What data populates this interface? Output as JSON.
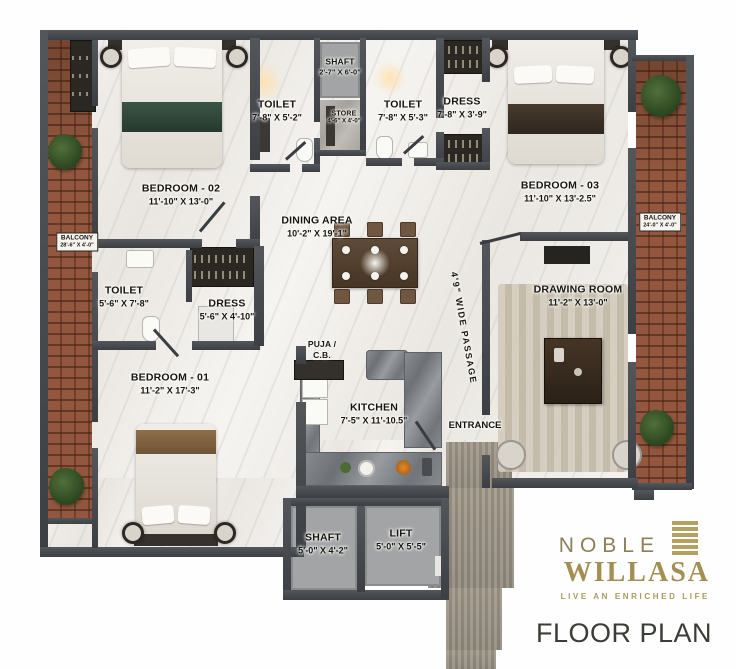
{
  "brand": {
    "name": "NOBLE",
    "logo": "WILLASA",
    "tagline": "LIVE AN ENRICHED LIFE",
    "plan_title": "FLOOR PLAN",
    "gold": "#a28f51",
    "dark": "#3a3e36"
  },
  "rooms": {
    "bedroom02": {
      "name": "BEDROOM - 02",
      "dims": "11'-10\" X 13'-0\""
    },
    "toilet_top_left": {
      "name": "TOILET",
      "dims": "7'-8\" X 5'-2\""
    },
    "shaft_top": {
      "name": "SHAFT",
      "dims": "2'-7\" X 6'-0\""
    },
    "store": {
      "name": "STORE",
      "dims": "4'-6\" X 4'-0\""
    },
    "toilet_top_right": {
      "name": "TOILET",
      "dims": "7'-8\" X 5'-3\""
    },
    "dress_top": {
      "name": "DRESS",
      "dims": "7'-8\" X 3'-9\""
    },
    "bedroom03": {
      "name": "BEDROOM - 03",
      "dims": "11'-10\" X 13'-2.5\""
    },
    "dining": {
      "name": "DINING AREA",
      "dims": "10'-2\" X 19'-1\""
    },
    "balcony_left": {
      "name": "BALCONY",
      "dims": "28'-6\" X 4'-0\""
    },
    "balcony_right": {
      "name": "BALCONY",
      "dims": "24'-0\" X 4'-0\""
    },
    "toilet_mid": {
      "name": "TOILET",
      "dims": "5'-6\" X 7'-8\""
    },
    "dress_mid": {
      "name": "DRESS",
      "dims": "5'-6\" X 4'-10\""
    },
    "bedroom01": {
      "name": "BEDROOM - 01",
      "dims": "11'-2\" X 17'-3\""
    },
    "puja": {
      "name": "PUJA /",
      "dims": "C.B."
    },
    "kitchen": {
      "name": "KITCHEN",
      "dims": "7'-5\" X 11'-10.5\""
    },
    "drawing": {
      "name": "DRAWING ROOM",
      "dims": "11'-2\" X 13'-0\""
    },
    "passage": {
      "name": "4'9\" WIDE PASSAGE"
    },
    "entrance": {
      "name": "ENTRANCE"
    },
    "shaft_bottom": {
      "name": "SHAFT",
      "dims": "5'-0\" X 4'-2\""
    },
    "lift": {
      "name": "LIFT",
      "dims": "5'-0\" X 5'-5\""
    }
  }
}
